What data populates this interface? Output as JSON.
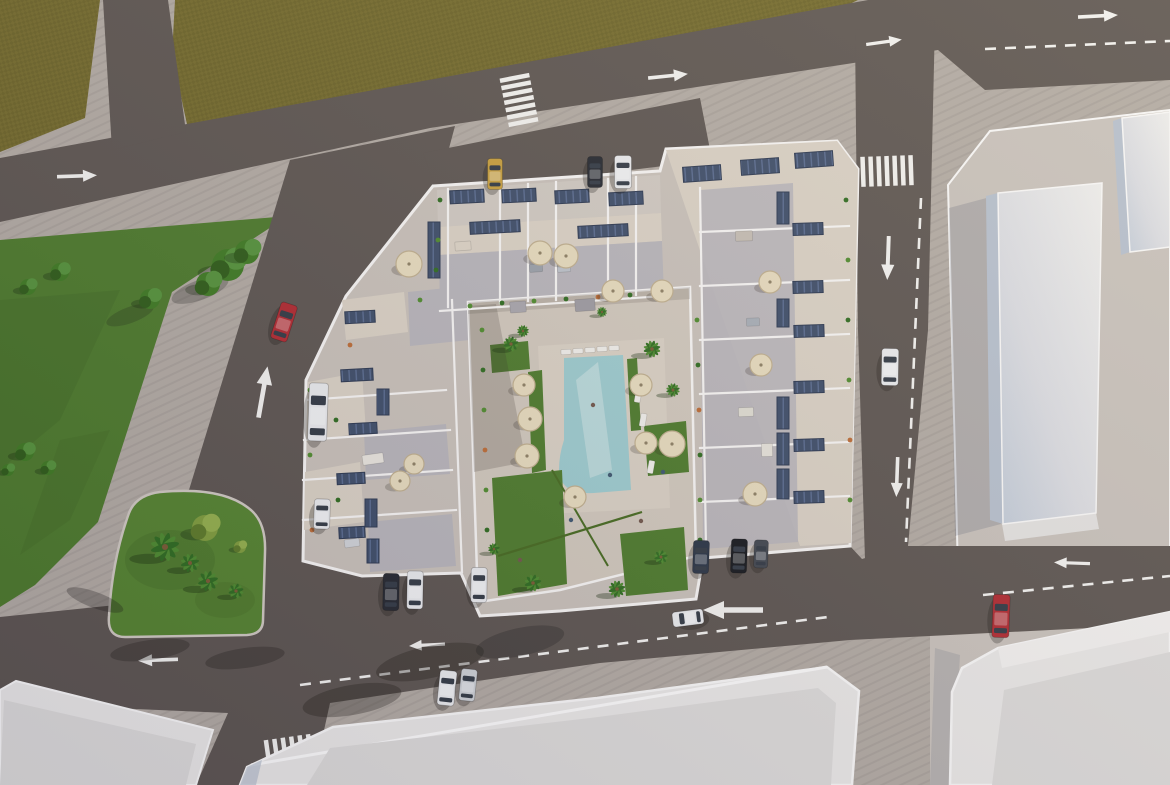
{
  "meta": {
    "title": "Aerial 3D architectural render: residential apartment complex with rooftop solar panels and terraces around a courtyard pool, surrounded by roads, lawns, a landscaped traffic island and neighbouring white buildings",
    "view": "top-down bird's eye",
    "time_of_day": "late afternoon, long shadows toward lower-left"
  },
  "colors": {
    "road": "#5d5550",
    "sidewalk": "#b2aaa2",
    "field": "#746a2b",
    "fieldDark": "#665d24",
    "lawn": "#4d7a2b",
    "lawnDark": "#3a5f1e",
    "island": "#55832f",
    "roof": "#c8c0b8",
    "roofLight": "#cfc8c0",
    "terrace": "#d9d0c3",
    "roofShade": "#b7b4b9",
    "wallWhite": "#f6f4f2",
    "plaza": "#d0c7bb",
    "deck": "#d8cfc2",
    "pool": "#9ccacd",
    "poolLight": "#c2dcdc",
    "solar": "#3e4d68",
    "solarLine": "#5d6f94",
    "umbrella": "#e6dabc",
    "umbrellaEdge": "#bfae8d",
    "bldgTop": "#e9e7e5",
    "bldgSide": "#b6bfcc",
    "bldgFace": "#dcdad8",
    "bldgRim": "#f8f7f6",
    "plot": "#c8c1ba",
    "mark": "#f2f1ee",
    "glass": "#333a44",
    "carRed": "#b02a30",
    "carWhite": "#e9eaec",
    "carSilver": "#cdd0d4",
    "carYellow": "#c79e3c",
    "carDark": "#25282f",
    "carBlack": "#17191d",
    "carNavy": "#2b3545",
    "carGray": "#42474f"
  },
  "scene": {
    "solar_panels": [
      [
        450,
        190,
        34,
        13,
        -3
      ],
      [
        502,
        189,
        34,
        13,
        -3
      ],
      [
        555,
        190,
        34,
        13,
        -3
      ],
      [
        609,
        192,
        34,
        13,
        -3
      ],
      [
        683,
        166,
        38,
        15,
        -4
      ],
      [
        741,
        159,
        38,
        15,
        -4
      ],
      [
        795,
        152,
        38,
        15,
        -4
      ],
      [
        470,
        221,
        50,
        12,
        -3
      ],
      [
        578,
        225,
        50,
        12,
        -3
      ],
      [
        428,
        222,
        12,
        56,
        0
      ],
      [
        777,
        192,
        12,
        32,
        0
      ],
      [
        793,
        223,
        30,
        12,
        -2
      ],
      [
        793,
        281,
        30,
        12,
        -2
      ],
      [
        777,
        299,
        12,
        28,
        0
      ],
      [
        794,
        325,
        30,
        12,
        -2
      ],
      [
        794,
        381,
        30,
        12,
        -2
      ],
      [
        777,
        397,
        12,
        32,
        0
      ],
      [
        777,
        433,
        12,
        32,
        0
      ],
      [
        794,
        439,
        30,
        12,
        -2
      ],
      [
        794,
        491,
        30,
        12,
        -2
      ],
      [
        777,
        469,
        12,
        30,
        0
      ],
      [
        345,
        311,
        30,
        12,
        -3
      ],
      [
        341,
        369,
        32,
        12,
        -3
      ],
      [
        377,
        389,
        12,
        26,
        0
      ],
      [
        349,
        423,
        28,
        11,
        -3
      ],
      [
        337,
        473,
        28,
        11,
        -3
      ],
      [
        365,
        499,
        12,
        28,
        0
      ],
      [
        339,
        527,
        26,
        11,
        -3
      ],
      [
        367,
        539,
        12,
        24,
        0
      ]
    ],
    "umbrellas": [
      [
        409,
        264,
        13
      ],
      [
        540,
        253,
        12
      ],
      [
        566,
        256,
        12
      ],
      [
        613,
        291,
        11
      ],
      [
        662,
        291,
        11
      ],
      [
        524,
        385,
        11
      ],
      [
        530,
        419,
        12
      ],
      [
        527,
        456,
        12
      ],
      [
        641,
        385,
        11
      ],
      [
        646,
        443,
        11
      ],
      [
        672,
        444,
        13
      ],
      [
        575,
        497,
        11
      ],
      [
        770,
        282,
        11
      ],
      [
        761,
        365,
        11
      ],
      [
        755,
        494,
        12
      ],
      [
        414,
        464,
        10
      ],
      [
        400,
        481,
        10
      ]
    ],
    "palms": [
      [
        165,
        547,
        1.7
      ],
      [
        190,
        563,
        1.1
      ],
      [
        208,
        581,
        1.2
      ],
      [
        236,
        591,
        0.9
      ],
      [
        511,
        344,
        0.9
      ],
      [
        523,
        331,
        0.7
      ],
      [
        652,
        349,
        1.0
      ],
      [
        673,
        390,
        0.8
      ],
      [
        533,
        583,
        1.0
      ],
      [
        617,
        589,
        1.0
      ],
      [
        661,
        557,
        0.8
      ],
      [
        494,
        549,
        0.7
      ],
      [
        602,
        312,
        0.6
      ]
    ],
    "trees": [
      [
        228,
        265,
        16,
        "g"
      ],
      [
        247,
        252,
        12,
        "g"
      ],
      [
        208,
        284,
        12,
        "g"
      ],
      [
        150,
        299,
        10,
        "g"
      ],
      [
        60,
        272,
        9,
        "g"
      ],
      [
        28,
        287,
        8,
        "g"
      ],
      [
        25,
        452,
        9,
        "g"
      ],
      [
        48,
        468,
        7,
        "g"
      ],
      [
        8,
        470,
        6,
        "g"
      ],
      [
        205,
        528,
        13,
        "y"
      ],
      [
        240,
        547,
        6,
        "y"
      ]
    ],
    "plants": [
      [
        470,
        306
      ],
      [
        502,
        303
      ],
      [
        534,
        301
      ],
      [
        566,
        299
      ],
      [
        598,
        297
      ],
      [
        630,
        295
      ],
      [
        482,
        330
      ],
      [
        483,
        370
      ],
      [
        484,
        410
      ],
      [
        485,
        450
      ],
      [
        486,
        490
      ],
      [
        487,
        530
      ],
      [
        697,
        320
      ],
      [
        698,
        365
      ],
      [
        699,
        410
      ],
      [
        700,
        455
      ],
      [
        700,
        500
      ],
      [
        700,
        540
      ],
      [
        420,
        300
      ],
      [
        350,
        345
      ],
      [
        310,
        390
      ],
      [
        336,
        420
      ],
      [
        310,
        455
      ],
      [
        338,
        500
      ],
      [
        312,
        530
      ],
      [
        846,
        200
      ],
      [
        848,
        260
      ],
      [
        848,
        320
      ],
      [
        849,
        380
      ],
      [
        850,
        440
      ],
      [
        850,
        500
      ],
      [
        440,
        200
      ],
      [
        438,
        240
      ],
      [
        436,
        270
      ]
    ],
    "cars": [
      [
        284,
        322,
        18,
        17,
        38,
        "carRed"
      ],
      [
        318,
        412,
        2,
        19,
        58,
        "carWhite"
      ],
      [
        322,
        514,
        2,
        16,
        30,
        "carWhite"
      ],
      [
        495,
        174,
        0,
        15,
        31,
        "carYellow"
      ],
      [
        595,
        172,
        0,
        15,
        31,
        "carDark"
      ],
      [
        623,
        172,
        0,
        17,
        33,
        "carWhite"
      ],
      [
        890,
        367,
        1,
        17,
        37,
        "carWhite"
      ],
      [
        391,
        592,
        1,
        16,
        37,
        "carDark"
      ],
      [
        415,
        590,
        1,
        16,
        38,
        "carWhite"
      ],
      [
        479,
        585,
        1,
        16,
        35,
        "carWhite"
      ],
      [
        701,
        557,
        2,
        16,
        33,
        "carNavy"
      ],
      [
        739,
        556,
        2,
        16,
        34,
        "carBlack"
      ],
      [
        761,
        554,
        2,
        14,
        28,
        "carGray"
      ],
      [
        688,
        618,
        -97,
        15,
        31,
        "carWhite"
      ],
      [
        447,
        688,
        6,
        17,
        35,
        "carWhite"
      ],
      [
        468,
        685,
        6,
        16,
        32,
        "carSilver"
      ],
      [
        1001,
        616,
        2,
        17,
        43,
        "carRed"
      ]
    ],
    "arrows": [
      [
        77,
        176,
        -2,
        1
      ],
      [
        668,
        76,
        -6,
        1
      ],
      [
        1098,
        16,
        -3,
        1
      ],
      [
        884,
        42,
        -8,
        0.9
      ],
      [
        888,
        258,
        92,
        1.1
      ],
      [
        897,
        477,
        92,
        1
      ],
      [
        263,
        392,
        -80,
        1.3
      ],
      [
        158,
        660,
        178,
        1
      ],
      [
        427,
        645,
        177,
        0.9
      ],
      [
        733,
        610,
        180,
        1.5
      ],
      [
        1072,
        563,
        182,
        0.9
      ]
    ],
    "lane_dashes": [
      [
        985,
        49,
        1170,
        41
      ],
      [
        921,
        198,
        906,
        542
      ],
      [
        300,
        685,
        828,
        617
      ],
      [
        983,
        595,
        1170,
        576
      ]
    ],
    "crosswalks": [
      [
        519,
        100,
        -11,
        7,
        30,
        4.5,
        0,
        7.5
      ],
      [
        887,
        171,
        -2,
        7,
        4.5,
        30,
        8,
        0
      ],
      [
        289,
        752,
        -8,
        6,
        4.5,
        30,
        8.5,
        0
      ]
    ],
    "furniture": [
      [
        463,
        246,
        16,
        9,
        -4,
        "#dbd2c4"
      ],
      [
        536,
        268,
        13,
        8,
        -4,
        "#9aa0a8"
      ],
      [
        564,
        268,
        13,
        8,
        -4,
        "#bcc1c8"
      ],
      [
        744,
        236,
        17,
        10,
        -2,
        "#c4bcb2"
      ],
      [
        753,
        322,
        13,
        8,
        -2,
        "#a7adb5"
      ],
      [
        373,
        459,
        21,
        10,
        -8,
        "#e8e4dc"
      ],
      [
        352,
        543,
        15,
        8,
        -8,
        "#cfd2d6"
      ],
      [
        746,
        412,
        15,
        9,
        -2,
        "#dedbd0"
      ],
      [
        767,
        450,
        11,
        13,
        -2,
        "#e5e1d8"
      ],
      [
        585,
        305,
        20,
        12,
        -4,
        "#9d9aa0"
      ],
      [
        518,
        307,
        16,
        11,
        -4,
        "#a8a5ab"
      ],
      [
        566,
        352,
        10,
        5,
        -3,
        "#efede8"
      ],
      [
        578,
        351,
        10,
        5,
        -3,
        "#efede8"
      ],
      [
        590,
        350,
        10,
        5,
        -3,
        "#efede8"
      ],
      [
        602,
        349,
        10,
        5,
        -3,
        "#efede8"
      ],
      [
        614,
        348,
        10,
        5,
        -3,
        "#efede8"
      ],
      [
        638,
        396,
        13,
        6,
        -80,
        "#efede8"
      ],
      [
        643,
        420,
        13,
        6,
        -80,
        "#efede8"
      ],
      [
        647,
        444,
        13,
        6,
        -80,
        "#efede8"
      ],
      [
        651,
        467,
        13,
        6,
        -80,
        "#efede8"
      ]
    ],
    "people": [
      [
        593,
        405
      ],
      [
        571,
        520
      ],
      [
        641,
        521
      ],
      [
        663,
        472
      ],
      [
        520,
        560
      ],
      [
        610,
        475
      ]
    ],
    "shadow_blobs": [
      [
        430,
        662,
        55,
        16,
        -12,
        0.3
      ],
      [
        520,
        642,
        45,
        14,
        -12,
        0.25
      ],
      [
        352,
        700,
        50,
        15,
        -10,
        0.3
      ],
      [
        150,
        650,
        40,
        10,
        -8,
        0.28
      ],
      [
        245,
        658,
        40,
        10,
        -8,
        0.28
      ],
      [
        200,
        290,
        30,
        10,
        -20,
        0.25
      ],
      [
        130,
        315,
        25,
        8,
        -20,
        0.22
      ],
      [
        95,
        600,
        30,
        8,
        20,
        0.28
      ]
    ]
  }
}
